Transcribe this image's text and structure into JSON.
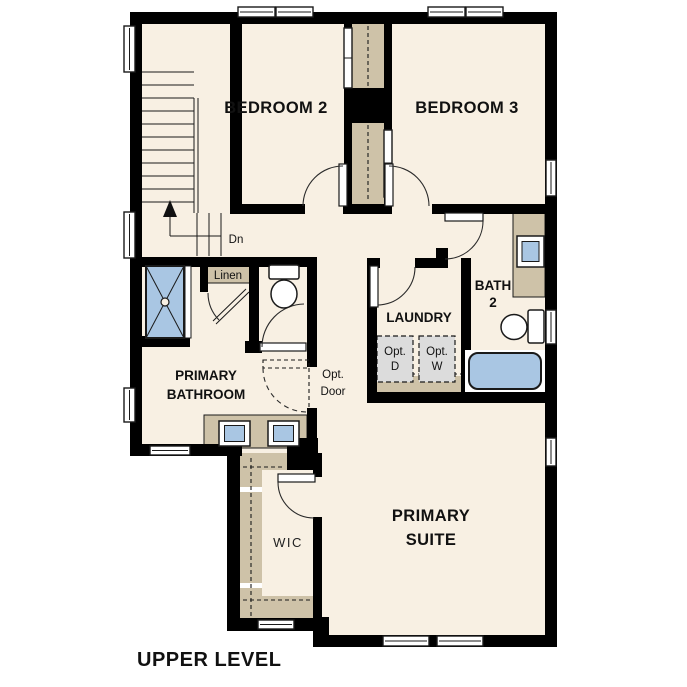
{
  "footer": {
    "title": "UPPER LEVEL"
  },
  "rooms": {
    "bedroom2": {
      "label": "BEDROOM 2"
    },
    "bedroom3": {
      "label": "BEDROOM 3"
    },
    "primary_bathroom": {
      "line1": "PRIMARY",
      "line2": "BATHROOM"
    },
    "laundry": {
      "label": "LAUNDRY"
    },
    "bath2": {
      "line1": "BATH",
      "line2": "2"
    },
    "primary_suite": {
      "line1": "PRIMARY",
      "line2": "SUITE"
    },
    "wic": {
      "label": "WIC"
    }
  },
  "annotations": {
    "stairs_direction": "Dn",
    "linen": "Linen",
    "opt_door": {
      "line1": "Opt.",
      "line2": "Door"
    },
    "opt_dryer": {
      "line1": "Opt.",
      "line2": "D"
    },
    "opt_washer": {
      "line1": "Opt.",
      "line2": "W"
    }
  },
  "colors": {
    "background": "#ffffff",
    "floor": "#f8f0e3",
    "wall": "#000000",
    "casework": "#cec2a8",
    "fixture_blue": "#a9c6e3",
    "appliance_gray": "#dcdcdc"
  }
}
